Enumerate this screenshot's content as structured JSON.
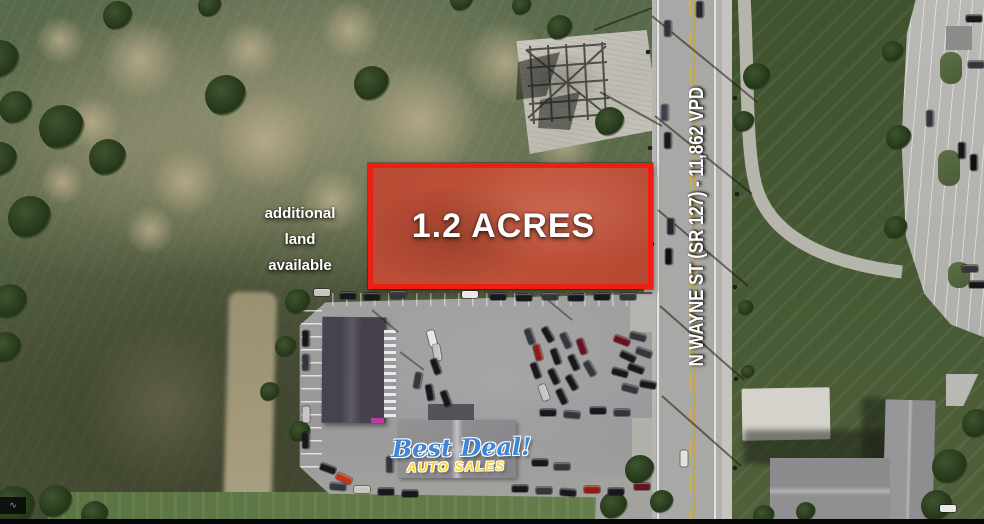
{
  "annotations": {
    "acreage_label": "1.2 ACRES",
    "additional_land_lines": [
      "additional",
      "land",
      "available"
    ],
    "road_label": "N WAYNE ST (SR 127) - 11,862 VPD"
  },
  "logo": {
    "script_text": "Best Deal!",
    "subtitle_text": "AUTO SALES"
  },
  "watermark_glyph": "∿",
  "colors": {
    "parcel_fill": "#d8301c",
    "parcel_border": "#f01d12",
    "label_text": "#ffffff",
    "logo_script": "#3f86d8",
    "logo_subtitle": "#ffd21c"
  }
}
